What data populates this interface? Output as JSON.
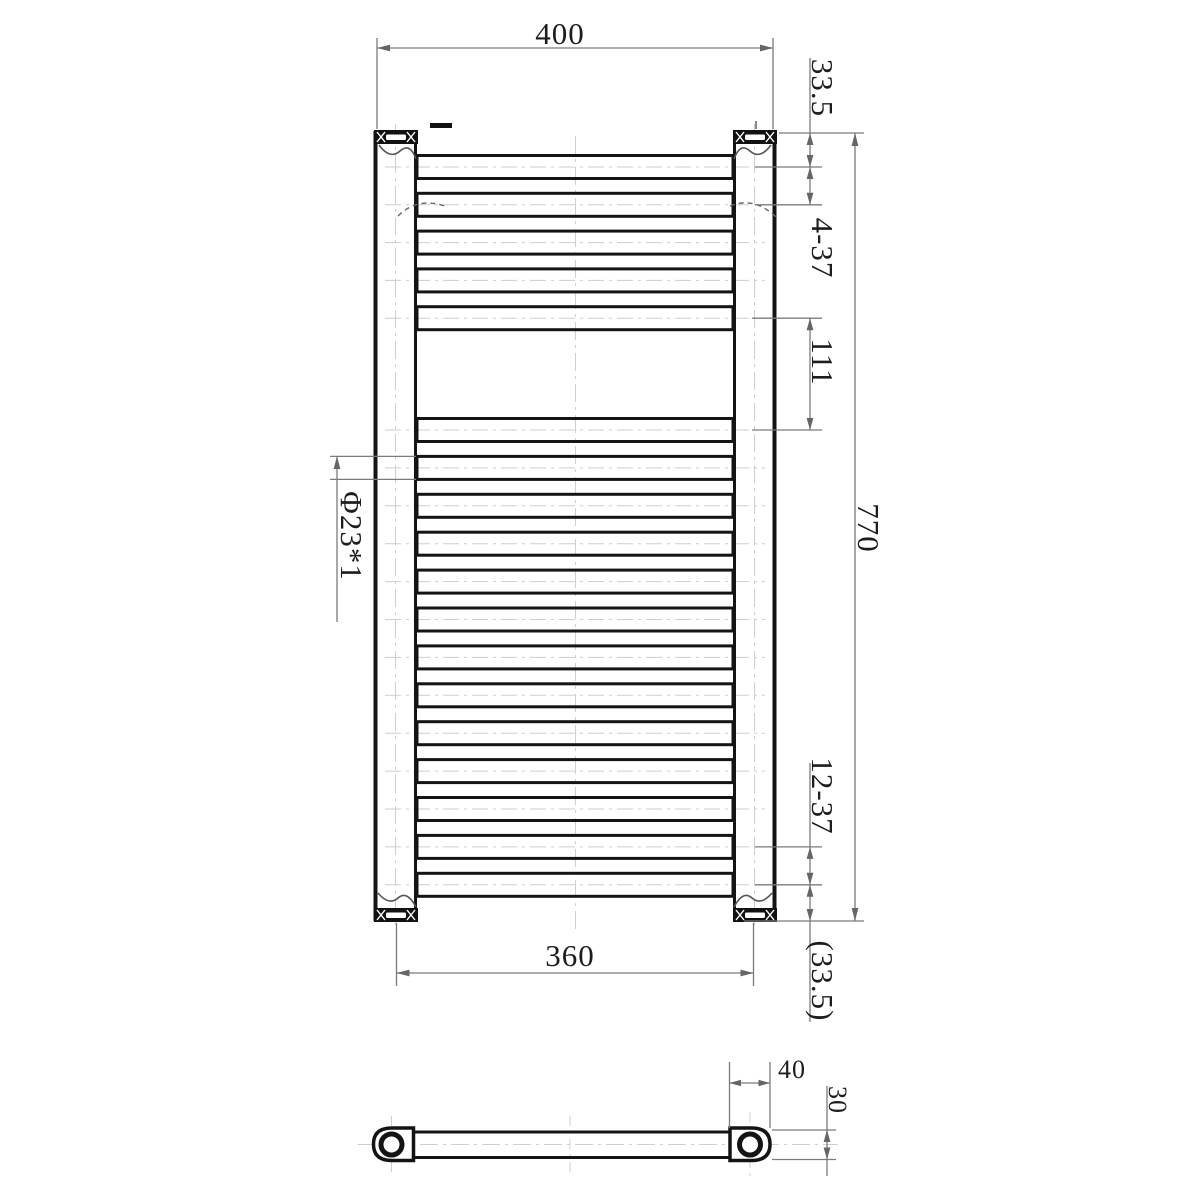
{
  "drawing": {
    "front_view": {
      "overall_width": "400",
      "top_offset": "33.5",
      "top_rung_pitch": "4-37",
      "middle_gap": "111",
      "overall_height": "770",
      "bottom_rung_pitch": "12-37",
      "bottom_offset_ref": "(33.5)",
      "mounting_centers_width": "360",
      "rung_tube_spec": "Φ23*1",
      "rung_count_top_group": 5,
      "rung_count_bottom_group": 13
    },
    "side_view": {
      "end_fitting_width": "40",
      "rail_depth": "30"
    }
  }
}
